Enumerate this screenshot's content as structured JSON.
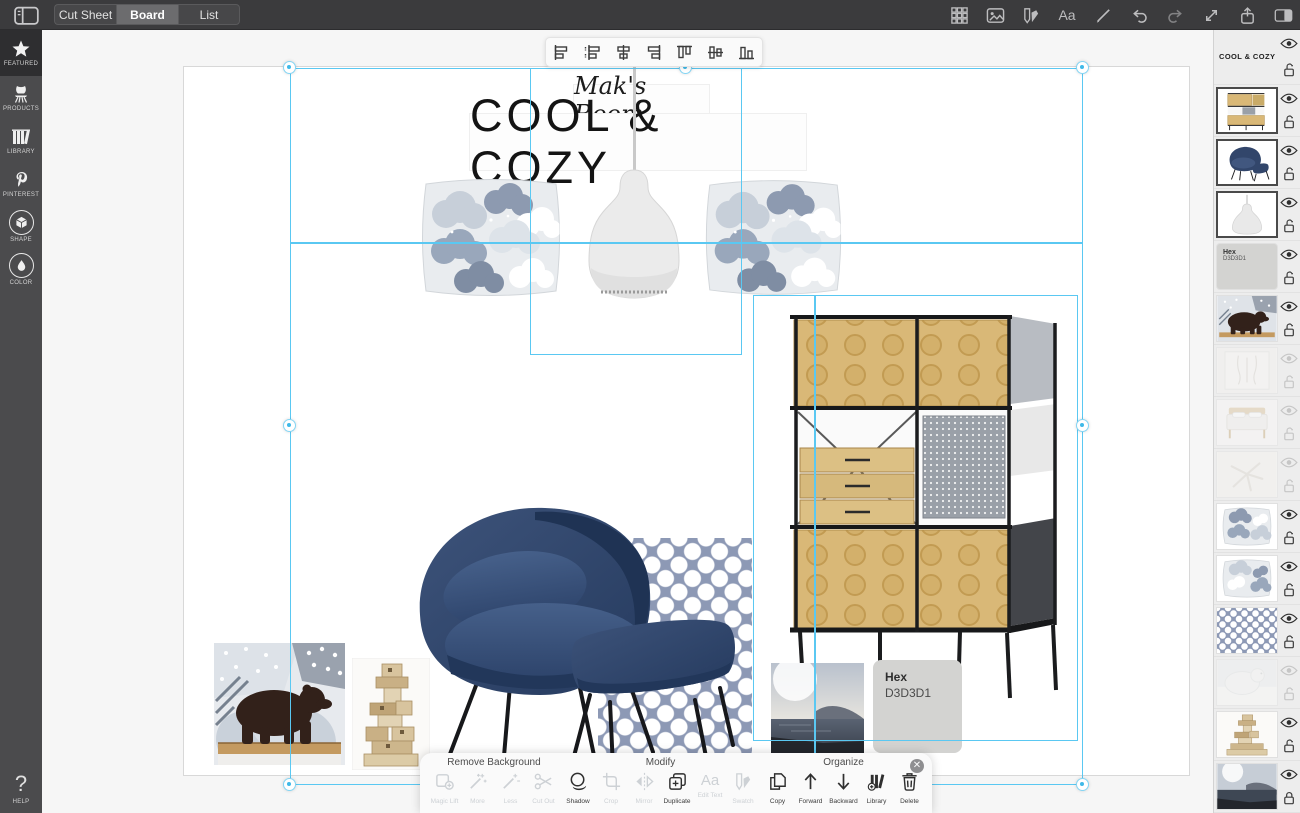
{
  "topbar": {
    "left_icon": "sidebar-toggle-icon",
    "tabs": [
      {
        "label": "Cut Sheet",
        "active": false
      },
      {
        "label": "Board",
        "active": true
      },
      {
        "label": "List",
        "active": false
      }
    ],
    "right_icons": [
      "grid-view-icon",
      "image-icon",
      "swatch-icon",
      "text-icon",
      "draw-icon",
      "undo-icon",
      "redo-icon",
      "fullscreen-icon",
      "share-icon",
      "panel-toggle-icon"
    ],
    "text_icon_glyph": "Aa"
  },
  "sidebar": {
    "items": [
      {
        "label": "FEATURED",
        "icon": "star-icon",
        "active": true
      },
      {
        "label": "PRODUCTS",
        "icon": "chair-icon",
        "active": false
      },
      {
        "label": "LIBRARY",
        "icon": "books-icon",
        "active": false
      },
      {
        "label": "PINTEREST",
        "icon": "pinterest-icon",
        "active": false
      },
      {
        "label": "SHAPE",
        "icon": "cube-icon",
        "active": false
      },
      {
        "label": "COLOR",
        "icon": "droplet-icon",
        "active": false
      }
    ],
    "help": {
      "label": "HELP",
      "icon": "question-icon",
      "glyph": "?"
    }
  },
  "board": {
    "subtitle": "Mak's Room",
    "title": "COOL & COZY",
    "hex_swatch": {
      "label": "Hex",
      "value": "D3D3D1",
      "color": "#D3D3D1"
    }
  },
  "align_toolbar": {
    "icons": [
      "align-left-icon",
      "distribute-left-icon",
      "align-center-h-icon",
      "align-right-icon",
      "align-top-icon",
      "align-middle-v-icon",
      "align-bottom-icon"
    ]
  },
  "context_toolbar": {
    "close_icon": "close-icon",
    "close_glyph": "✕",
    "groups": [
      {
        "label": "Remove Background",
        "buttons": [
          {
            "label": "Magic Lift",
            "icon": "magic-lift-icon",
            "enabled": false
          },
          {
            "label": "More",
            "icon": "wand-more-icon",
            "enabled": false
          },
          {
            "label": "Less",
            "icon": "wand-less-icon",
            "enabled": false
          },
          {
            "label": "Cut Out",
            "icon": "scissors-icon",
            "enabled": false
          }
        ]
      },
      {
        "label": "Modify",
        "buttons": [
          {
            "label": "Shadow",
            "icon": "shadow-icon",
            "enabled": true
          },
          {
            "label": "Crop",
            "icon": "crop-icon",
            "enabled": false
          },
          {
            "label": "Mirror",
            "icon": "mirror-icon",
            "enabled": false
          },
          {
            "label": "Duplicate",
            "icon": "duplicate-icon",
            "enabled": true
          },
          {
            "label": "Edit Text",
            "icon": "edit-text-icon",
            "enabled": false,
            "glyph": "Aa"
          },
          {
            "label": "Swatch",
            "icon": "swatch-icon",
            "enabled": false
          }
        ]
      },
      {
        "label": "Organize",
        "buttons": [
          {
            "label": "Copy",
            "icon": "copy-icon",
            "enabled": true
          },
          {
            "label": "Forward",
            "icon": "arrow-up-icon",
            "enabled": true
          },
          {
            "label": "Backward",
            "icon": "arrow-down-icon",
            "enabled": true
          },
          {
            "label": "Library",
            "icon": "library-add-icon",
            "enabled": true
          },
          {
            "label": "Delete",
            "icon": "trash-icon",
            "enabled": true
          }
        ]
      }
    ]
  },
  "layers_panel": {
    "items": [
      {
        "name": "title-text-layer",
        "label": "COOL & COZY",
        "visible": true,
        "locked": false,
        "selected": false
      },
      {
        "name": "storage-unit-layer",
        "visible": true,
        "locked": false,
        "selected": true
      },
      {
        "name": "armchair-layer",
        "visible": true,
        "locked": false,
        "selected": true
      },
      {
        "name": "pendant-lamp-layer",
        "visible": true,
        "locked": false,
        "selected": true
      },
      {
        "name": "hex-swatch-layer",
        "label": "Hex",
        "value": "D3D3D1",
        "visible": true,
        "locked": false,
        "selected": false
      },
      {
        "name": "bear-figurine-layer",
        "visible": true,
        "locked": false,
        "selected": false
      },
      {
        "name": "wall-hanging-layer",
        "visible": false,
        "locked": false,
        "selected": false
      },
      {
        "name": "bed-layer",
        "visible": false,
        "locked": false,
        "selected": false
      },
      {
        "name": "starfish-layer",
        "visible": false,
        "locked": false,
        "selected": false
      },
      {
        "name": "cloud-pillow-layer",
        "visible": true,
        "locked": false,
        "selected": false
      },
      {
        "name": "cloud-pillow-2-layer",
        "visible": true,
        "locked": false,
        "selected": false
      },
      {
        "name": "dot-pattern-layer",
        "visible": true,
        "locked": false,
        "selected": false
      },
      {
        "name": "polar-bear-layer",
        "visible": false,
        "locked": false,
        "selected": false
      },
      {
        "name": "wood-blocks-layer",
        "visible": true,
        "locked": false,
        "selected": false
      },
      {
        "name": "seascape-photo-layer",
        "visible": true,
        "locked": true,
        "selected": false
      }
    ]
  },
  "colors": {
    "selection_accent": "#57C6F2",
    "topbar_bg": "#3B3B3D",
    "sidebar_bg": "#4B4B4D",
    "panel_bg": "#EDEDED",
    "hex_swatch": "#D3D3D1"
  }
}
